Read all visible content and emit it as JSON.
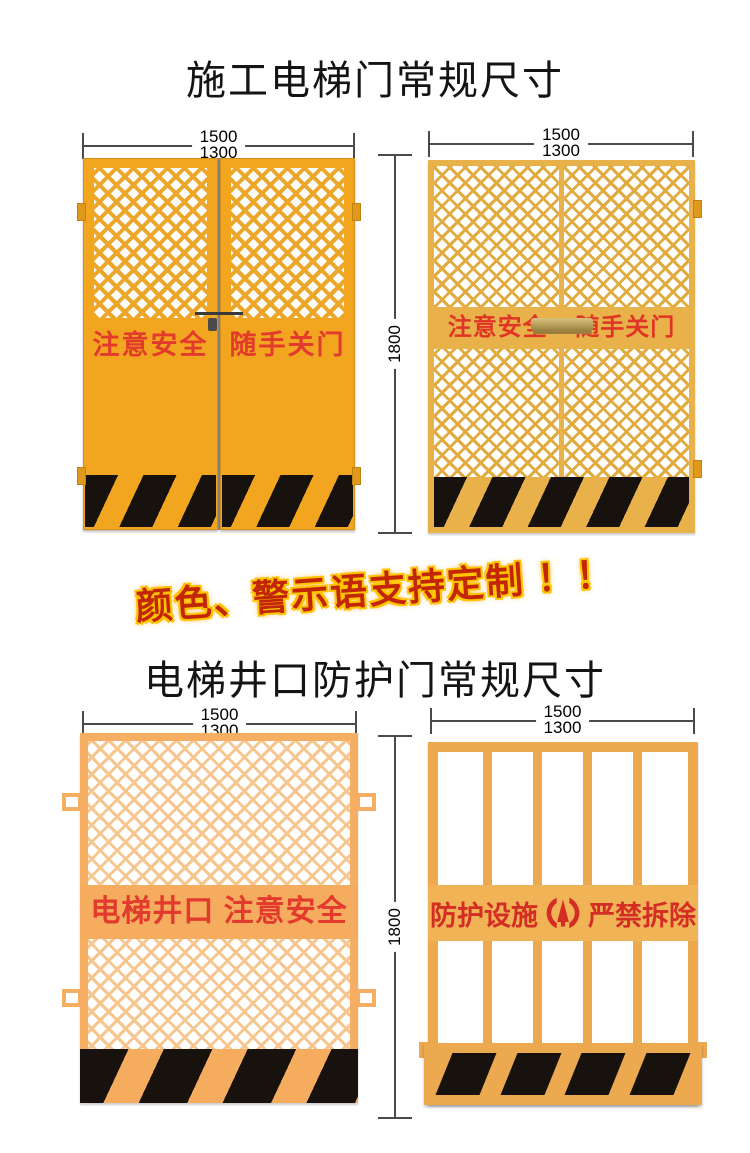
{
  "titles": {
    "construction_door": "施工电梯门常规尺寸",
    "shaft_door": "电梯井口防护门常规尺寸"
  },
  "banner": {
    "text": "颜色、警示语支持定制 ！！"
  },
  "dimensions": {
    "outer_width": "1500",
    "inner_width": "1300",
    "height": "1800"
  },
  "doors": {
    "construction_left": {
      "slogan_left": "注意安全",
      "slogan_right": "随手关门"
    },
    "construction_right": {
      "slogan_left": "注意安全",
      "slogan_right": "随手关门"
    },
    "shaft_left": {
      "slogan": "电梯井口 注意安全"
    },
    "shaft_right": {
      "slogan_left": "防护设施",
      "slogan_right": "严禁拆除",
      "logo_icon": "builder-emblem"
    }
  },
  "colors": {
    "door_yellow": "#F2A61F",
    "mesh_door_yellow": "#E9B14A",
    "gate_orange": "#F5AE62",
    "bar_gate_orange": "#EDA94F",
    "slogan_red": "#E23B2D",
    "hazard_black": "#17120E",
    "banner_red": "#C22605",
    "banner_glow": "#FFC400",
    "dim_line_gray": "#4A4A4A"
  }
}
